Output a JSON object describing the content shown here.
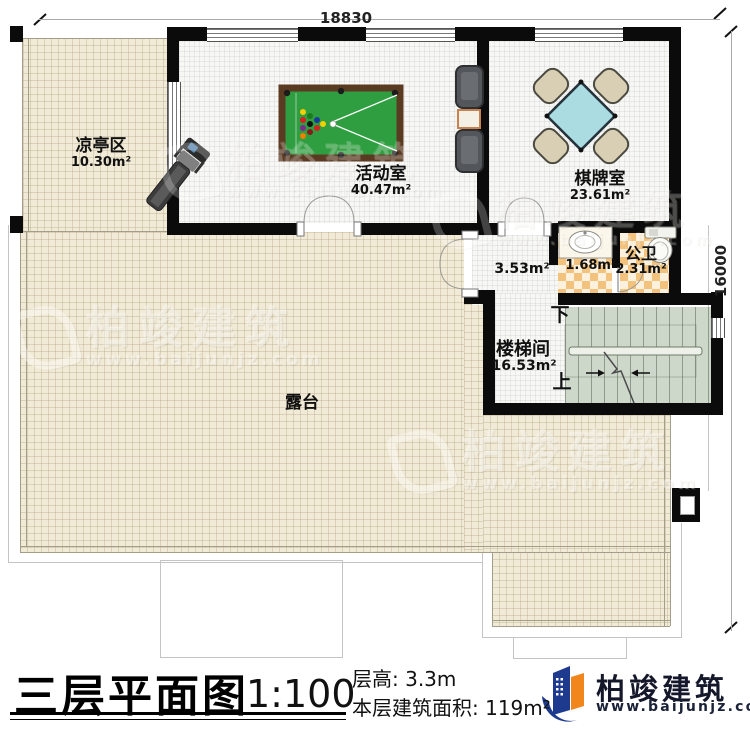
{
  "titleblock": {
    "plan_title": "三层平面图",
    "scale": "1:100",
    "floor_height": "层高: 3.3m",
    "floor_area": "本层建筑面积: 119m²"
  },
  "brand": {
    "name": "柏竣建筑",
    "site": "www.baijunjz.com"
  },
  "dims": {
    "width": "18830",
    "height": "16000"
  },
  "rooms": {
    "pavilion": {
      "name": "凉亭区",
      "area": "10.30m²"
    },
    "activity": {
      "name": "活动室",
      "area": "40.47m²"
    },
    "chess": {
      "name": "棋牌室",
      "area": "23.61m²"
    },
    "wash": {
      "area": "1.68m²"
    },
    "toilet": {
      "name": "公卫",
      "area": "2.31m²"
    },
    "hall": {
      "area": "3.53m²"
    },
    "stairwell": {
      "name": "楼梯间",
      "area": "16.53m²"
    },
    "terrace": {
      "name": "露台"
    }
  },
  "stairs": {
    "down": "下",
    "up": "上"
  },
  "colors": {
    "wall": "#0b0b0b",
    "terrace_floor": "#f1ead7",
    "interior_floor": "#f7f7f5",
    "tile_orange": "#f3c37e",
    "stair_green": "#cdd8ca",
    "pool_felt": "#2f9e41",
    "pool_frame": "#5b3a22",
    "table_teal": "#aadce1",
    "chair_beige": "#d9cfb4",
    "brand_navy": "#1d3a8f",
    "brand_orange": "#f0861c"
  }
}
